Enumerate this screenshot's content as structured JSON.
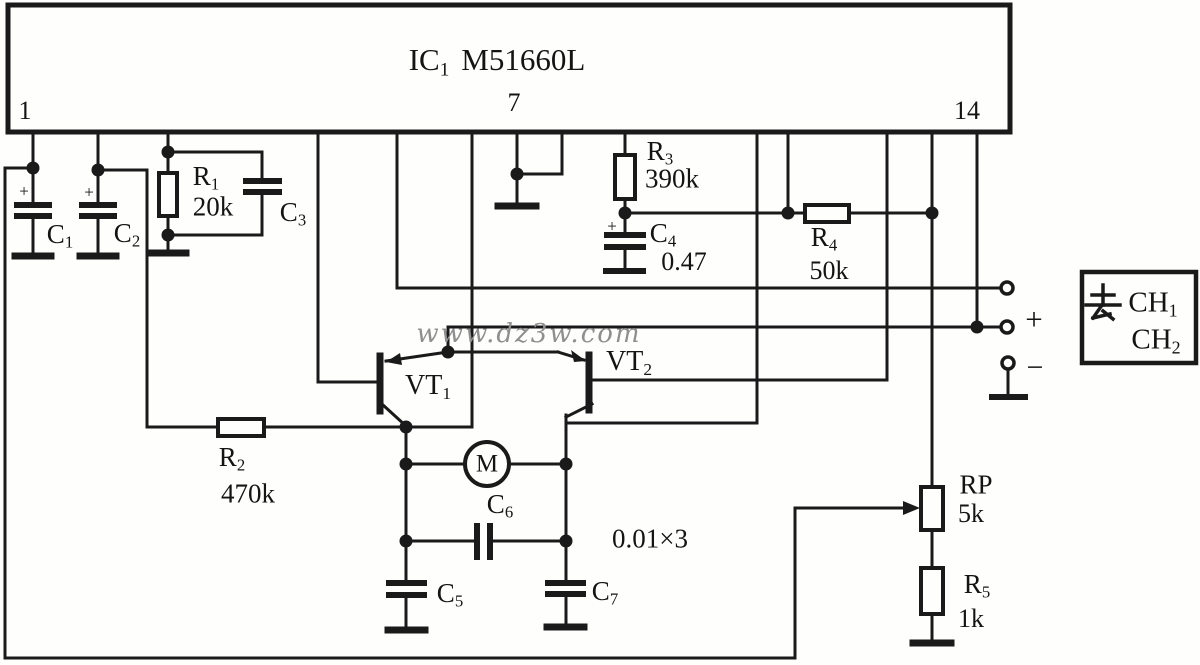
{
  "ic": {
    "name_main": "IC",
    "name_sub": "1",
    "part": "M51660L",
    "pins": {
      "p1": "1",
      "p7": "7",
      "p14": "14"
    }
  },
  "watermark": "www.dz3w.com",
  "terminals": {
    "plus": "+",
    "minus": "−"
  },
  "output_box": {
    "qu": "去",
    "ch1_main": "CH",
    "ch1_sub": "1",
    "ch2_main": "CH",
    "ch2_sub": "2"
  },
  "colors": {
    "ink": "#1a1a1a",
    "watermark": "#8f8f8f",
    "background": "#fefefd"
  },
  "component_labels": [
    {
      "name": "cap-c1-label",
      "x": 60,
      "y": 236,
      "fs": 27,
      "segs": [
        {
          "t": "C"
        },
        {
          "t": "1",
          "sub": true
        }
      ]
    },
    {
      "name": "cap-c1-polarity",
      "x": 24,
      "y": 191,
      "fs": 17,
      "segs": [
        {
          "t": "+"
        }
      ]
    },
    {
      "name": "cap-c2-label",
      "x": 127,
      "y": 235,
      "fs": 27,
      "segs": [
        {
          "t": "C"
        },
        {
          "t": "2",
          "sub": true
        }
      ]
    },
    {
      "name": "cap-c2-polarity",
      "x": 89,
      "y": 192,
      "fs": 17,
      "segs": [
        {
          "t": "+"
        }
      ]
    },
    {
      "name": "res-r1-label",
      "x": 206,
      "y": 178,
      "fs": 27,
      "segs": [
        {
          "t": "R"
        },
        {
          "t": "1",
          "sub": true
        }
      ]
    },
    {
      "name": "res-r1-value",
      "x": 213,
      "y": 207,
      "fs": 27,
      "segs": [
        {
          "t": "20k"
        }
      ]
    },
    {
      "name": "cap-c3-label",
      "x": 293,
      "y": 214,
      "fs": 27,
      "segs": [
        {
          "t": "C"
        },
        {
          "t": "3",
          "sub": true
        }
      ]
    },
    {
      "name": "res-r3-label",
      "x": 660,
      "y": 153,
      "fs": 27,
      "segs": [
        {
          "t": "R"
        },
        {
          "t": "3",
          "sub": true
        }
      ]
    },
    {
      "name": "res-r3-value",
      "x": 672,
      "y": 179,
      "fs": 27,
      "segs": [
        {
          "t": "390k"
        }
      ]
    },
    {
      "name": "cap-c4-label",
      "x": 663,
      "y": 235,
      "fs": 27,
      "segs": [
        {
          "t": "C"
        },
        {
          "t": "4",
          "sub": true
        }
      ]
    },
    {
      "name": "cap-c4-value",
      "x": 684,
      "y": 262,
      "fs": 26,
      "segs": [
        {
          "t": "0.47"
        }
      ]
    },
    {
      "name": "cap-c4-polarity",
      "x": 612,
      "y": 226,
      "fs": 17,
      "segs": [
        {
          "t": "+"
        }
      ]
    },
    {
      "name": "res-r4-label",
      "x": 824,
      "y": 239,
      "fs": 27,
      "segs": [
        {
          "t": "R"
        },
        {
          "t": "4",
          "sub": true
        }
      ]
    },
    {
      "name": "res-r4-value",
      "x": 829,
      "y": 271,
      "fs": 26,
      "segs": [
        {
          "t": "50k"
        }
      ]
    },
    {
      "name": "res-r2-label",
      "x": 232,
      "y": 459,
      "fs": 27,
      "segs": [
        {
          "t": "R"
        },
        {
          "t": "2",
          "sub": true
        }
      ]
    },
    {
      "name": "res-r2-value",
      "x": 248,
      "y": 494,
      "fs": 27,
      "segs": [
        {
          "t": "470k"
        }
      ]
    },
    {
      "name": "transistor-vt1-label",
      "x": 428,
      "y": 387,
      "fs": 28,
      "segs": [
        {
          "t": "VT"
        },
        {
          "t": "1",
          "sub": true
        }
      ]
    },
    {
      "name": "transistor-vt2-label",
      "x": 629,
      "y": 363,
      "fs": 28,
      "segs": [
        {
          "t": "VT"
        },
        {
          "t": "2",
          "sub": true
        }
      ]
    },
    {
      "name": "motor-label",
      "x": 487,
      "y": 464,
      "fs": 25,
      "segs": [
        {
          "t": "M"
        }
      ]
    },
    {
      "name": "cap-c6-label",
      "x": 500,
      "y": 506,
      "fs": 27,
      "segs": [
        {
          "t": "C"
        },
        {
          "t": "6",
          "sub": true
        }
      ]
    },
    {
      "name": "cap-value-note",
      "x": 650,
      "y": 539,
      "fs": 27,
      "segs": [
        {
          "t": "0.01×3"
        }
      ]
    },
    {
      "name": "cap-c5-label",
      "x": 450,
      "y": 595,
      "fs": 27,
      "segs": [
        {
          "t": "C"
        },
        {
          "t": "5",
          "sub": true
        }
      ]
    },
    {
      "name": "cap-c7-label",
      "x": 605,
      "y": 593,
      "fs": 27,
      "segs": [
        {
          "t": "C"
        },
        {
          "t": "7",
          "sub": true
        }
      ]
    },
    {
      "name": "pot-rp-label",
      "x": 976,
      "y": 485,
      "fs": 27,
      "segs": [
        {
          "t": "RP"
        }
      ]
    },
    {
      "name": "pot-rp-value",
      "x": 971,
      "y": 514,
      "fs": 26,
      "segs": [
        {
          "t": "5k"
        }
      ]
    },
    {
      "name": "res-r5-label",
      "x": 977,
      "y": 586,
      "fs": 27,
      "segs": [
        {
          "t": "R"
        },
        {
          "t": "5",
          "sub": true
        }
      ]
    },
    {
      "name": "res-r5-value",
      "x": 971,
      "y": 619,
      "fs": 26,
      "segs": [
        {
          "t": "1k"
        }
      ]
    }
  ]
}
